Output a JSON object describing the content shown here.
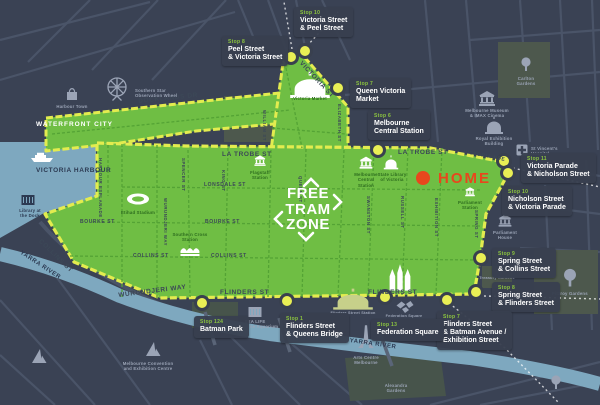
{
  "zone_title": "FREE\nTRAM\nZONE",
  "home_label": "HOME",
  "colors": {
    "background": "#3A4254",
    "zone_green": "#6FBE44",
    "route_yellow": "#E3EC4F",
    "water_blue": "#7EA8BF",
    "home_red": "#E8471D",
    "label_box": "#383F4F",
    "stop_number_green": "#8DC63F"
  },
  "stops": [
    {
      "label": "Stop 10",
      "name": "Victoria Street\n& Peel Street"
    },
    {
      "label": "Stop 8",
      "name": "Peel Street\n& Victoria Street"
    },
    {
      "label": "Stop 7",
      "name": "Queen Victoria\nMarket"
    },
    {
      "label": "Stop 6",
      "name": "Melbourne\nCentral Station"
    },
    {
      "label": "Stop 11",
      "name": "Victoria Parade\n& Nicholson Street"
    },
    {
      "label": "Stop 10",
      "name": "Nicholson Street\n& Victoria Parade"
    },
    {
      "label": "Stop 9",
      "name": "Spring Street\n& Collins Street"
    },
    {
      "label": "Stop 8",
      "name": "Spring Street\n& Flinders Street"
    },
    {
      "label": "Stop 7",
      "name": "Flinders Street\n& Batman Avenue /\nExhibition Street"
    },
    {
      "label": "Stop 13",
      "name": "Federation Square"
    },
    {
      "label": "Stop 1",
      "name": "Flinders Street\n& Queens Bridge"
    },
    {
      "label": "Stop 124",
      "name": "Batman Park"
    }
  ],
  "streets": {
    "la_trobe": "LA TROBE ST",
    "lonsdale": "LONSDALE ST",
    "bourke": "BOURKE ST",
    "collins": "COLLINS ST",
    "flinders": "FLINDERS ST",
    "spencer": "SPENCER ST",
    "king": "KING ST",
    "william": "WILLIAM ST",
    "queen": "QUEEN ST",
    "elizabeth": "ELIZABETH ST",
    "swanston": "SWANSTON ST",
    "russell": "RUSSELL ST",
    "exhibition": "EXHIBITION ST",
    "spring": "SPRING ST",
    "victoria": "VICTORIA ST",
    "victoria_pde": "VICTORIA PDE",
    "docklands_dr": "DOCKLANDS DR",
    "harbour_esplanade": "HARBOUR ESPLANADE",
    "wurundjeri": "WURUNDJERI WAY"
  },
  "areas": {
    "waterfront_city": "WATERFRONT CITY",
    "victoria_harbour": "VICTORIA HARBOUR",
    "yarra_river": "YARRA RIVER"
  },
  "landmarks": {
    "southern_star": "Southern Star\nObservation Wheel",
    "harbour_town": "Harbour Town",
    "library_dock": "Library at\nthe Dock",
    "etihad": "Etihad Stadium",
    "southern_cross": "Southern Cross\nStation",
    "flagstaff": "Flagstaff\nStation",
    "melb_central": "Melbourne\nCentral\nStation",
    "state_library": "State Library\nof Victoria",
    "victoria_market": "Victoria Market",
    "museum": "Melbourne Museum\n& IMAX Cinema",
    "royal_exhibition": "Royal Exhibition\nBuilding",
    "st_vincents": "St Vincent's\nHospital",
    "parliament_station": "Parliament\nStation",
    "parliament_house": "Parliament\nHouse",
    "treasury": "Treasury Gardens",
    "fitzroy": "Fitzroy Gardens",
    "carlton": "Carlton\nGardens",
    "sealife": "SEA LIFE\nMelbourne Aquarium",
    "flinders_station": "Flinders Street Station",
    "fed_square": "Federation Square",
    "arts_centre": "Arts Centre\nMelbourne",
    "mcec": "Melbourne Convention\nand Exhibition Centre",
    "alexandra": "Alexandra\nGardens"
  }
}
